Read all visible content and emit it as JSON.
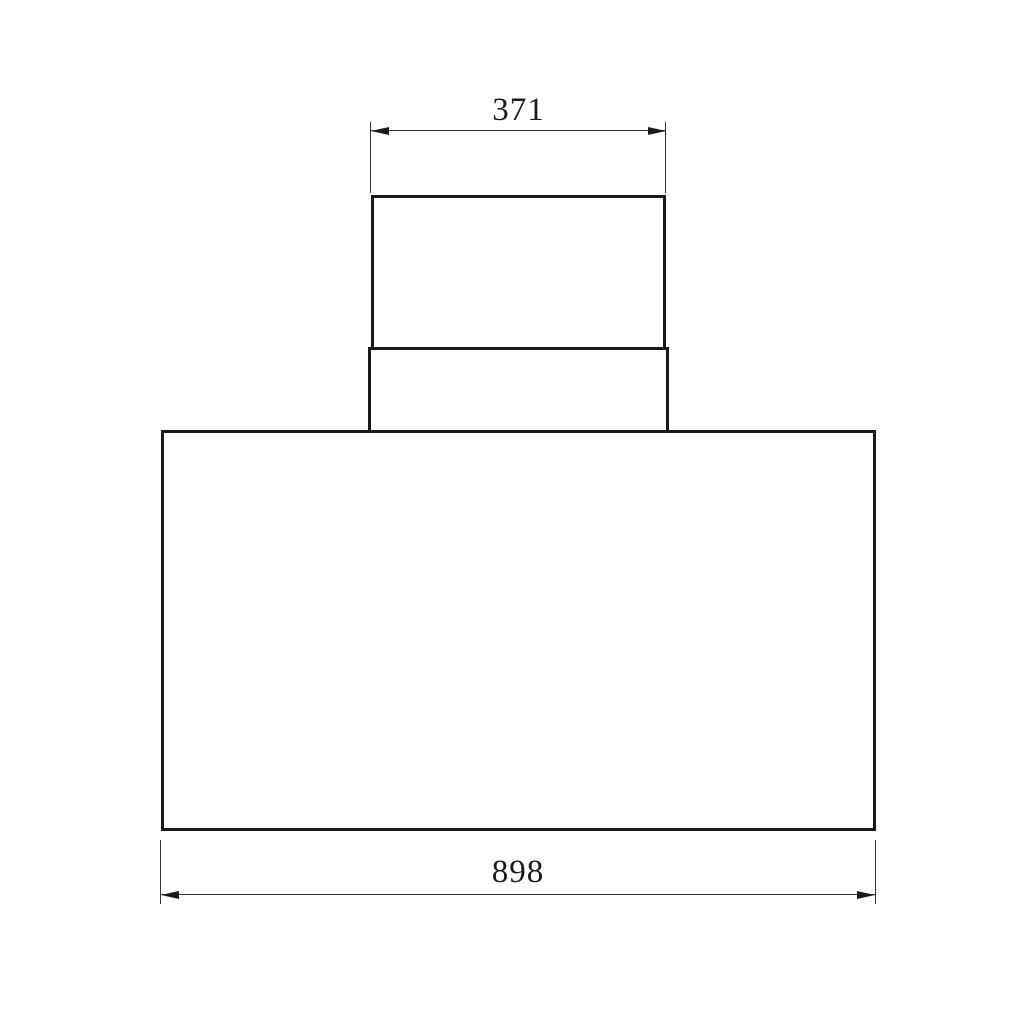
{
  "drawing": {
    "type": "technical-dimension-drawing",
    "background": "#ffffff",
    "object_line_color": "#1a1a1a",
    "dimension_line_color": "#333333",
    "shapes": [
      {
        "name": "duct-upper-rect"
      },
      {
        "name": "duct-collar-rect"
      },
      {
        "name": "hood-body-rect"
      }
    ],
    "dimensions": {
      "top": {
        "label": "371",
        "measures": "duct-upper-rect width"
      },
      "bottom": {
        "label": "898",
        "measures": "hood-body-rect width"
      }
    }
  }
}
